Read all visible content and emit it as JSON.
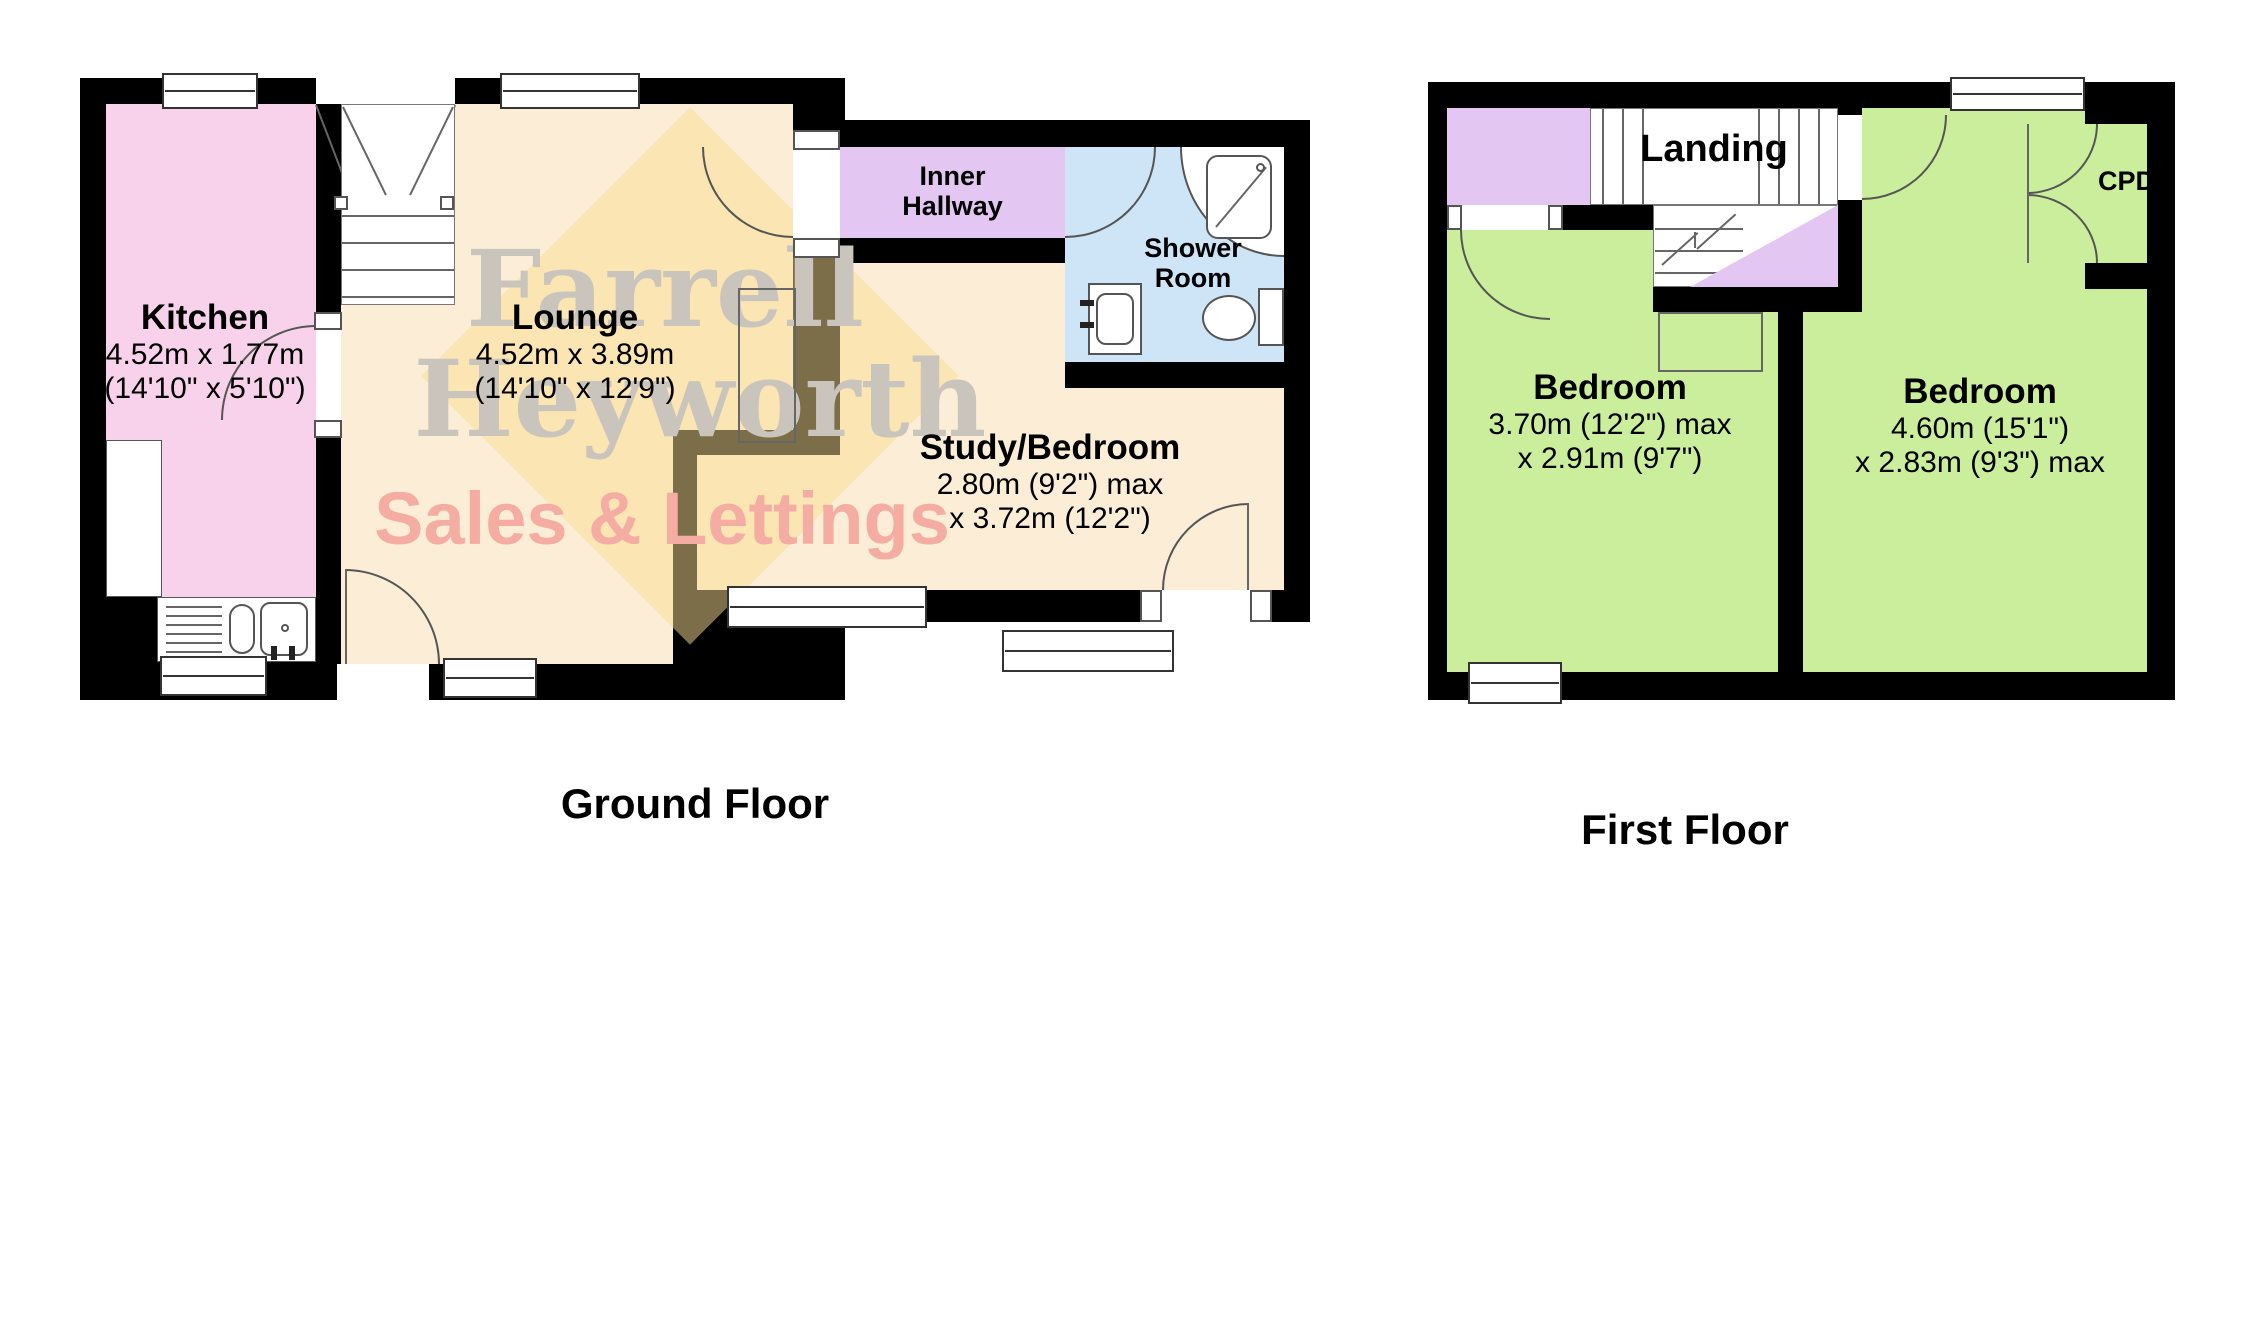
{
  "ground_floor": {
    "label": "Ground Floor",
    "kitchen": {
      "name": "Kitchen",
      "metric": "4.52m x 1.77m",
      "imperial": "(14'10\" x 5'10\")",
      "color": "#F8D2EB"
    },
    "lounge": {
      "name": "Lounge",
      "metric": "4.52m x 3.89m",
      "imperial": "(14'10\" x 12'9\")",
      "color": "#FCEED6"
    },
    "inner_hallway": {
      "line1": "Inner",
      "line2": "Hallway",
      "color": "#E4C6F2"
    },
    "shower_room": {
      "line1": "Shower",
      "line2": "Room",
      "color": "#CEE5F8"
    },
    "study_bedroom": {
      "name": "Study/Bedroom",
      "dims1": "2.80m (9'2\") max",
      "dims2": "x 3.72m (12'2\")",
      "color": "#FCEED6"
    }
  },
  "first_floor": {
    "label": "First Floor",
    "landing": {
      "name": "Landing",
      "color": "#E4C6F2"
    },
    "bedroom_left": {
      "name": "Bedroom",
      "dims1": "3.70m (12'2\") max",
      "dims2": "x 2.91m (9'7\")",
      "color": "#CBEE9D"
    },
    "bedroom_right": {
      "name": "Bedroom",
      "dims1": "4.60m (15'1\")",
      "dims2": "x 2.83m (9'3\") max",
      "color": "#CBEE9D"
    },
    "cupboard": {
      "name": "CPD"
    }
  },
  "watermark": {
    "line1": "Farrell",
    "line2": "Heyworth",
    "line3": "Sales & Lettings",
    "text_color": "#C9C4BC",
    "accent_color": "#F4ACA3",
    "diamond_color": "#F8DC8F"
  },
  "wall_color": "#000000"
}
